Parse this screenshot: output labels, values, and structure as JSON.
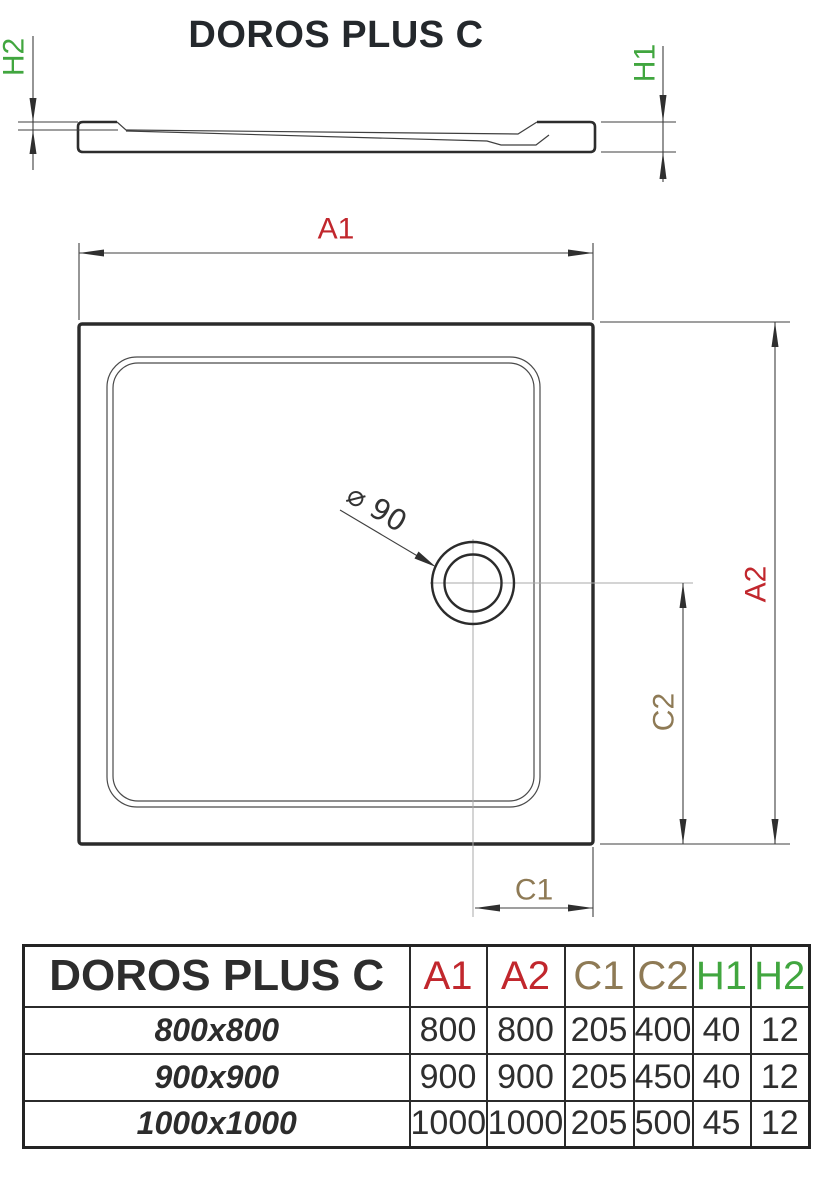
{
  "title": "DOROS PLUS C",
  "colors": {
    "dimension_red": "#c1272d",
    "dimension_green": "#41a63f",
    "dimension_brown": "#8e7a55",
    "drawing_line": "#2d2d2d"
  },
  "drawing": {
    "labels": {
      "h1": "H1",
      "h2": "H2",
      "a1": "A1",
      "a2": "A2",
      "c1": "C1",
      "c2": "C2",
      "drain_diameter": "⌀ 90"
    }
  },
  "table": {
    "product_name": "DOROS PLUS C",
    "columns": [
      "A1",
      "A2",
      "C1",
      "C2",
      "H1",
      "H2"
    ],
    "rows": [
      {
        "size": "800x800",
        "values": [
          "800",
          "800",
          "205",
          "400",
          "40",
          "12"
        ]
      },
      {
        "size": "900x900",
        "values": [
          "900",
          "900",
          "205",
          "450",
          "40",
          "12"
        ]
      },
      {
        "size": "1000x1000",
        "values": [
          "1000",
          "1000",
          "205",
          "500",
          "45",
          "12"
        ]
      }
    ]
  }
}
